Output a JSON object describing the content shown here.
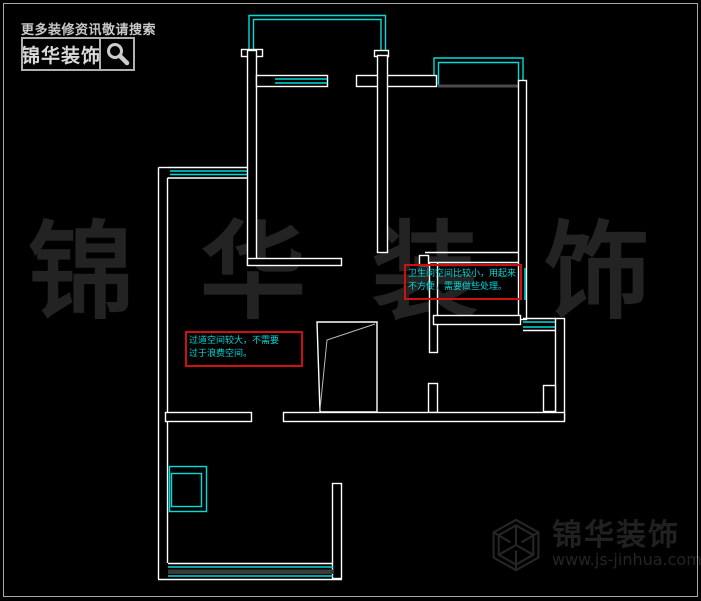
{
  "branding": {
    "search_hint": "更多装修资讯敬请搜索",
    "logo_text": "锦华装饰"
  },
  "watermark": {
    "center_text": "锦华装饰"
  },
  "footer_logo": {
    "name": "锦华装饰",
    "url": "www.js-jinhua.com"
  },
  "annotations": {
    "bathroom": {
      "line1": "卫生间空间比较小，用起来",
      "line2": "不方便，需要做些处理。"
    },
    "corridor": {
      "line1": "过道空间较大，不需要",
      "line2": "过于浪费空间。"
    }
  },
  "colors": {
    "background": "#000000",
    "wall": "#ffffff",
    "window_cyan": "#00dcdc",
    "annotation_border": "#cf1010",
    "annotation_text": "#00d8d8",
    "watermark_gray": "#232323",
    "brand_gray": "#c8c8c8"
  }
}
